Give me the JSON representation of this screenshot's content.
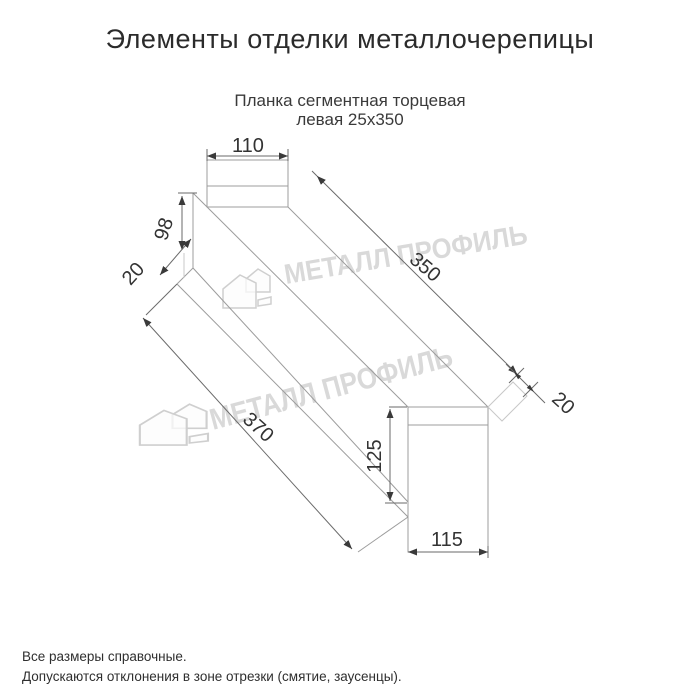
{
  "page": {
    "title": "Элементы отделки металлочерепицы"
  },
  "product": {
    "subtitle_line1": "Планка сегментная торцевая",
    "subtitle_line2": "левая 25х350"
  },
  "drawing": {
    "type": "technical-dimension-drawing",
    "dimensions": {
      "top_width": "110",
      "left_height": "98",
      "left_flange": "20",
      "top_length": "350",
      "end_flange": "20",
      "bottom_length": "370",
      "front_height": "125",
      "front_width": "115"
    }
  },
  "watermark": {
    "text": "МЕТАЛЛ ПРОФИЛЬ",
    "logo_icon": "metall-profil-logo"
  },
  "footer": {
    "note1": "Все размеры справочные.",
    "note2": "Допускаются отклонения в зоне отрезки (смятие, заусенцы)."
  },
  "colors": {
    "background": "#ffffff",
    "title_text": "#2b2b2b",
    "body_text": "#3a3a3a",
    "geometry_line": "#9c9c9c",
    "dimension_line": "#6a6a6a",
    "dimension_text": "#333333",
    "watermark": "#d9d9d9"
  }
}
